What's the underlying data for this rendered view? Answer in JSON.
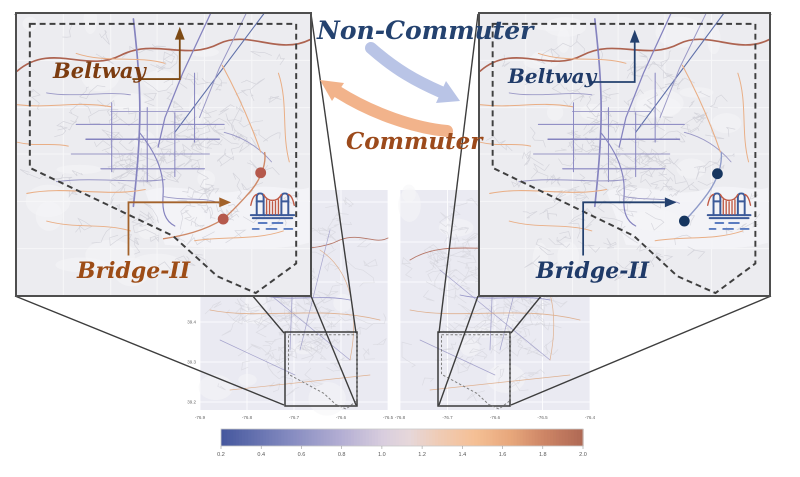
{
  "flow": {
    "non_commuter": "Non-Commuter",
    "commuter": "Commuter",
    "non_commuter_color": "#24426f",
    "commuter_color": "#9c4a1b",
    "arrow_blue": "#b9c4e6",
    "arrow_orange": "#f2b38b"
  },
  "panels": {
    "left": {
      "beltway": "Beltway",
      "bridge": "Bridge-II",
      "beltway_color": "#7c3c10",
      "bridge_color": "#9d4c16",
      "beltway_arrow_color": "#7d4a14",
      "bridge_arrow_color": "#a3622a",
      "dot_color": "#b5594c",
      "corridor_color": "#cf8a68"
    },
    "right": {
      "beltway": "Beltway",
      "bridge": "Bridge-II",
      "beltway_color": "#1f3a68",
      "bridge_color": "#1f3a68",
      "beltway_arrow_color": "#23406e",
      "bridge_arrow_color": "#23406e",
      "dot_color": "#16355f",
      "corridor_color": "#8f9bc9"
    }
  },
  "mini_maps": {
    "left": {
      "x_ticks": [
        "-76.9",
        "-76.8",
        "-76.7",
        "-76.6",
        "-76.5"
      ],
      "y_ticks": [
        "39.4",
        "39.3",
        "39.2"
      ]
    },
    "right": {
      "x_ticks": [
        "-76.8",
        "-76.7",
        "-76.6",
        "-76.5",
        "-76.4"
      ],
      "y_ticks": []
    }
  },
  "colorbar": {
    "min": 0.2,
    "max": 2.0,
    "ticks": [
      "0.2",
      "0.4",
      "0.6",
      "0.8",
      "1.0",
      "1.2",
      "1.4",
      "1.6",
      "1.8",
      "2.0"
    ],
    "gradient": [
      [
        0,
        "#46589e"
      ],
      [
        0.18,
        "#8289bf"
      ],
      [
        0.33,
        "#b3aed3"
      ],
      [
        0.45,
        "#d9cede"
      ],
      [
        0.52,
        "#e6d7da"
      ],
      [
        0.6,
        "#efccb6"
      ],
      [
        0.7,
        "#f5c096"
      ],
      [
        0.8,
        "#e8a87c"
      ],
      [
        0.9,
        "#cc8465"
      ],
      [
        1,
        "#b06a55"
      ]
    ]
  },
  "icons": {
    "bridge": "suspension-bridge"
  }
}
